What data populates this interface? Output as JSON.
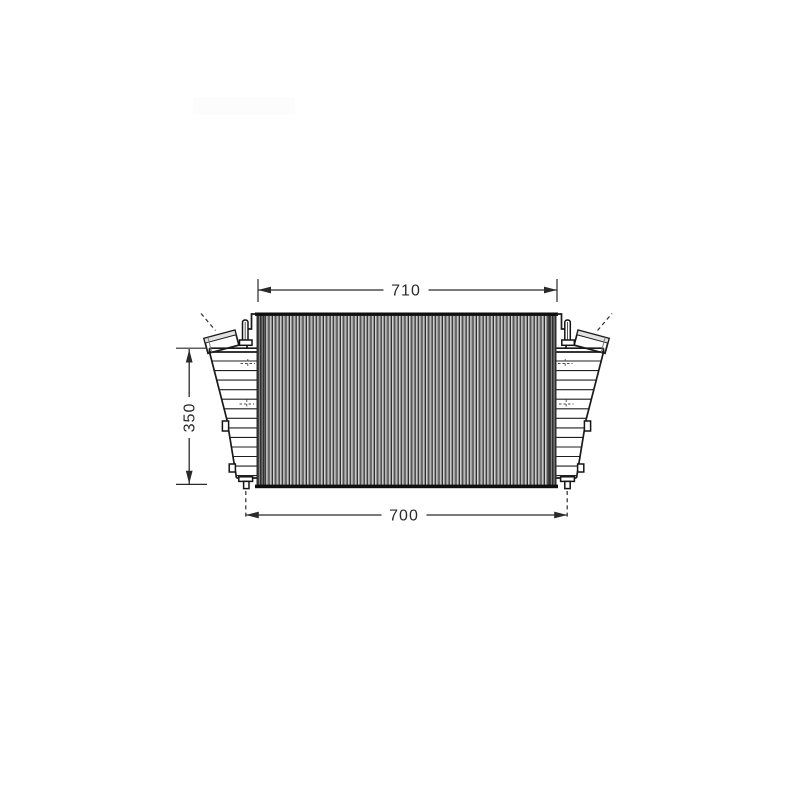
{
  "drawing": {
    "name": "intercooler-front-view-technical-drawing",
    "dimension_labels": {
      "top_width": "710",
      "bottom_width": "700",
      "left_height": "350"
    },
    "colors": {
      "line": "#1a1a1a",
      "dimension_text": "#2b2b2b",
      "core_dark_stripe": "#2d2d2d",
      "core_light_stripe": "#e6e6e6",
      "background": "#ffffff"
    }
  }
}
